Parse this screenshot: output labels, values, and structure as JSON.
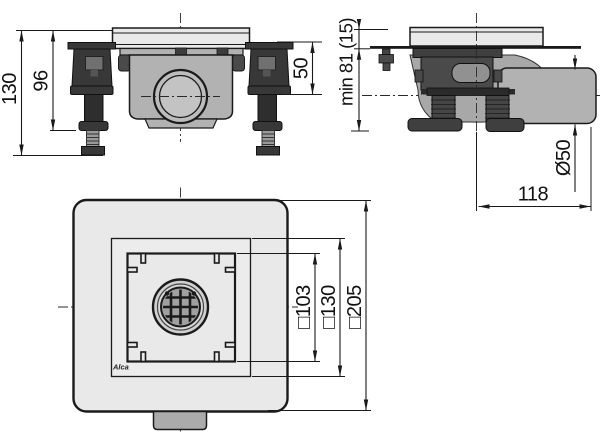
{
  "views": {
    "front": {
      "dims": {
        "total_height": "130",
        "leg_height": "96",
        "adjust_range": "50"
      }
    },
    "side": {
      "dims": {
        "min_depth": "min 81 (15)",
        "pipe_diameter": "Ø50",
        "outlet_length": "118"
      }
    },
    "top": {
      "dims": {
        "grate": "□103",
        "frame": "□130",
        "plate": "□205"
      },
      "brand": "Alca"
    }
  },
  "colors": {
    "background": "#ffffff",
    "line": "#1a1a1a",
    "plate_fill": "#e9e9e9",
    "body_fill": "#b2b2b2",
    "dark_fill": "#3d3d3d",
    "pipe_fill": "#b2b2b2"
  }
}
